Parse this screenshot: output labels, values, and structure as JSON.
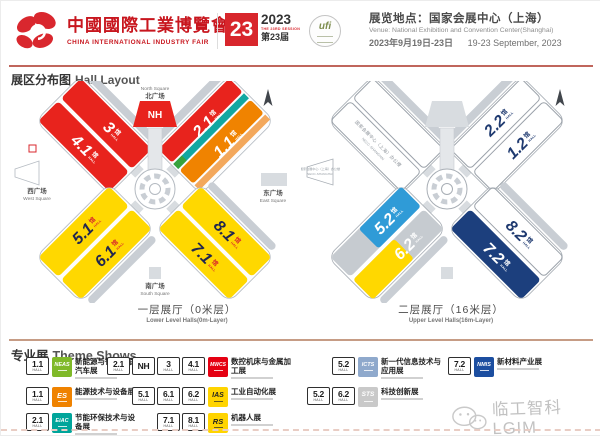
{
  "header": {
    "logo_title_cn": "中國國際工業博覽會",
    "logo_title_en": "CHINA INTERNATIONAL INDUSTRY FAIR",
    "badge_number": "23",
    "badge_year": "2023",
    "badge_session_en": "THE 23RD SESSION",
    "badge_session_cn": "第23届",
    "ufi_text": "ufi",
    "venue_cn": "展览地点：国家会展中心（上海）",
    "venue_en": "Venue: National Exhibition and Convention Center(Shanghai)",
    "date_cn": "2023年9月19日-23日",
    "date_en": "19-23 September, 2023"
  },
  "section": {
    "title_cn": "展区分布图",
    "title_en": "Hall Layout"
  },
  "maps": {
    "hall_cn": "馆",
    "hall_en": "HALL",
    "lower": {
      "halls": {
        "nh": "NH",
        "h3": "3",
        "h41": "4.1",
        "h21": "2.1",
        "h11": "1.1",
        "h51": "5.1",
        "h61": "6.1",
        "h81": "8.1",
        "h71": "7.1"
      },
      "north_en": "North Square",
      "north_cn": "北广场",
      "west_cn": "西广场",
      "west_en": "West Square",
      "east_cn": "东广场",
      "east_en": "East Square",
      "south_cn": "南广场",
      "south_en": "South Square",
      "caption_cn": "一层展厅（0米层）",
      "caption_en": "Lower Level Halls(0m-Layer)"
    },
    "upper": {
      "halls": {
        "h22": "2.2",
        "h12": "1.2",
        "h52": "5.2",
        "h62": "6.2",
        "h82": "8.2",
        "h72": "7.2"
      },
      "office_cn": "国家会展中心（上海）办公楼",
      "office_en": "NECC-SHANGHAI",
      "caption_cn": "二层展厅（16米层）",
      "caption_en": "Upper Level Halls(16m-Layer)"
    }
  },
  "legend": {
    "title_cn": "专业展",
    "title_en": "Theme Shows",
    "hall_unit": "HALL",
    "items": [
      {
        "halls": [
          "1.1"
        ],
        "logo": "NEAS",
        "color": "#7fb928",
        "name_cn": "新能源与智能网联汽车展"
      },
      {
        "halls": [
          "1.1"
        ],
        "logo": "ES",
        "color": "#ef8200",
        "name_cn": "能源技术与设备展"
      },
      {
        "halls": [
          "2.1"
        ],
        "logo": "EiAC",
        "color": "#00a59b",
        "name_cn": "节能环保技术与设备展"
      },
      {
        "halls": [
          "2.1",
          "NH",
          "3",
          "4.1"
        ],
        "logo": "MWCS",
        "color": "#e50012",
        "name_cn": "数控机床与金属加工展"
      },
      {
        "halls": [
          "5.1",
          "6.1",
          "6.2"
        ],
        "logo": "IAS",
        "color": "#ffd400",
        "name_cn": "工业自动化展"
      },
      {
        "halls": [
          "7.1",
          "8.1"
        ],
        "logo": "RS",
        "color": "#ffd400",
        "name_cn": "机器人展"
      },
      {
        "halls": [
          "5.2"
        ],
        "logo": "ICTS",
        "color": "#8fa9cc",
        "name_cn": "新一代信息技术与应用展"
      },
      {
        "halls": [
          "5.2",
          "6.2"
        ],
        "logo": "STS",
        "color": "#c9c9c9",
        "name_cn": "科技创新展"
      },
      {
        "halls": [
          "7.2"
        ],
        "logo": "NMIS",
        "color": "#1c4ea0",
        "name_cn": "新材料产业展"
      }
    ]
  },
  "watermark": {
    "text": "临工智科LGIM"
  }
}
